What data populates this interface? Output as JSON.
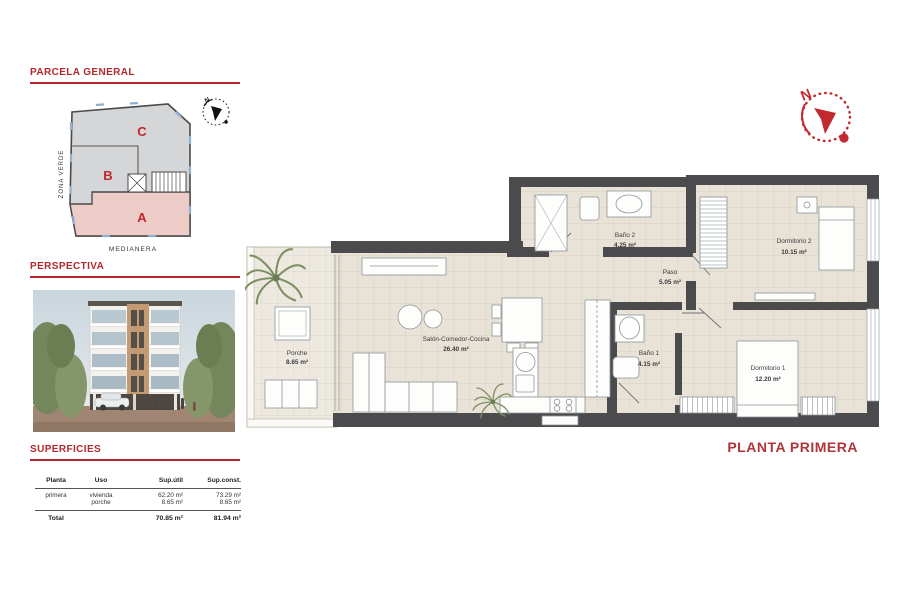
{
  "parcela": {
    "title": "PARCELA GENERAL",
    "zone_a": "A",
    "zone_b": "B",
    "zone_c": "C",
    "zona_verde": "ZONA VERDE",
    "medianera": "MEDIANERA",
    "north": "N"
  },
  "perspectiva": {
    "title": "PERSPECTIVA"
  },
  "superficies": {
    "title": "SUPERFICIES",
    "headers": [
      "Planta",
      "Uso",
      "Sup.útil",
      "Sup.const."
    ],
    "rows": [
      [
        "primera",
        "vivienda",
        "62.20 m²",
        "73.29 m²"
      ],
      [
        "",
        "porche",
        "8.65 m²",
        "8.65 m²"
      ]
    ],
    "total": [
      "Total",
      "",
      "70.85 m²",
      "81.94 m²"
    ]
  },
  "plan": {
    "title": "PLANTA PRIMERA",
    "north": "N",
    "rooms": [
      {
        "name": "Porche",
        "area": "8.65 m²"
      },
      {
        "name": "Salón-Comedor-Cocina",
        "area": "26.40 m²"
      },
      {
        "name": "Baño 2",
        "area": "4.25 m²"
      },
      {
        "name": "Paso",
        "area": "5.05 m²"
      },
      {
        "name": "Dormitorio 2",
        "area": "10.15 m²"
      },
      {
        "name": "Baño 1",
        "area": "4.15 m²"
      },
      {
        "name": "Dormitorio 1",
        "area": "12.20 m²"
      }
    ]
  },
  "colors": {
    "accent_red": "#b5272d",
    "compass_red": "#c2282e",
    "wall": "#4b4b4d",
    "floor": "#e9e2d7",
    "porch_floor": "#eee9e0",
    "parcel_gray": "#d5d6d8",
    "parcel_pink": "#edcbc6"
  }
}
